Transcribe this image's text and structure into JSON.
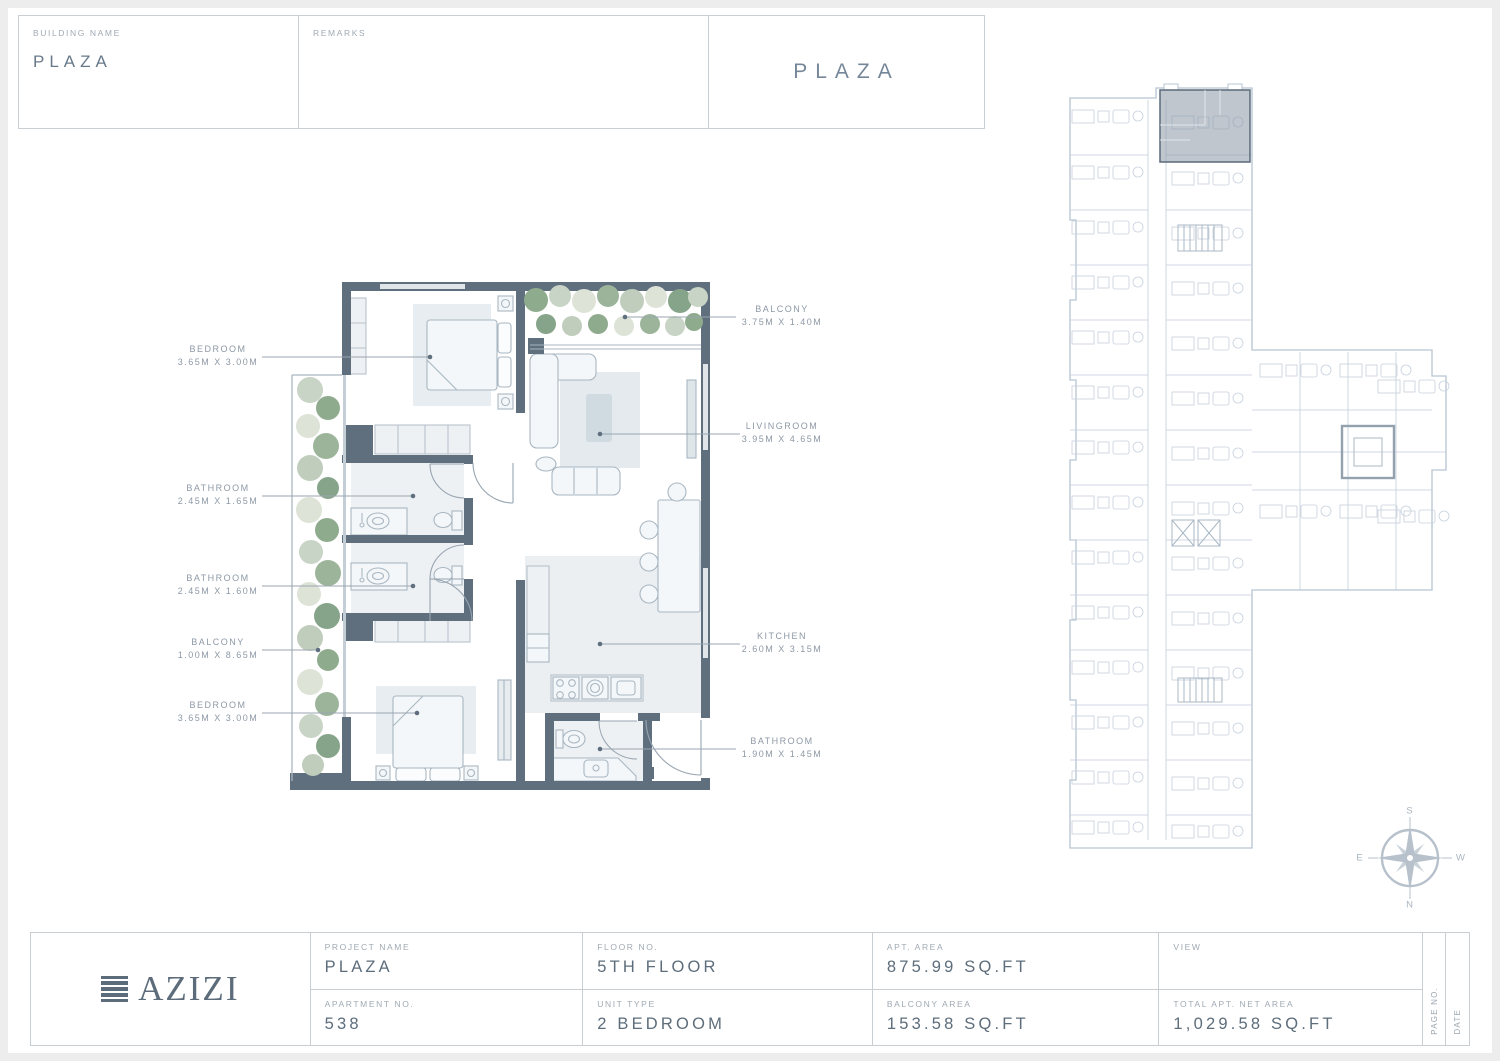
{
  "header": {
    "building_name_label": "BUILDING NAME",
    "building_name_value": "PLAZA",
    "remarks_label": "REMARKS",
    "sheet_title": "PLAZA"
  },
  "floor_plan": {
    "rooms": [
      {
        "name": "BEDROOM",
        "dims": "3.65M X 3.00M"
      },
      {
        "name": "BATHROOM",
        "dims": "2.45M X 1.65M"
      },
      {
        "name": "BATHROOM",
        "dims": "2.45M X 1.60M"
      },
      {
        "name": "BALCONY",
        "dims": "1.00M X 8.65M"
      },
      {
        "name": "BEDROOM",
        "dims": "3.65M X 3.00M"
      },
      {
        "name": "BALCONY",
        "dims": "3.75M X 1.40M"
      },
      {
        "name": "LIVINGROOM",
        "dims": "3.95M X 4.65M"
      },
      {
        "name": "KITCHEN",
        "dims": "2.60M X 3.15M"
      },
      {
        "name": "BATHROOM",
        "dims": "1.90M X 1.45M"
      }
    ]
  },
  "compass": {
    "north": "N",
    "south": "S",
    "east": "E",
    "west": "W"
  },
  "title_block": {
    "logo_text": "AZIZI",
    "project_name_label": "PROJECT NAME",
    "project_name_value": "PLAZA",
    "floor_no_label": "FLOOR NO.",
    "floor_no_value": "5TH FLOOR",
    "apt_area_label": "APT. AREA",
    "apt_area_value": "875.99 SQ.FT",
    "view_label": "VIEW",
    "view_value": "",
    "apartment_no_label": "APARTMENT NO.",
    "apartment_no_value": "538",
    "unit_type_label": "UNIT TYPE",
    "unit_type_value": "2 BEDROOM",
    "balcony_area_label": "BALCONY AREA",
    "balcony_area_value": "153.58 SQ.FT",
    "total_area_label": "TOTAL APT. NET AREA",
    "total_area_value": "1,029.58 SQ.FT",
    "page_no_label": "PAGE NO.",
    "date_label": "DATE"
  },
  "colors": {
    "wall": "#5f6f7e",
    "furniture_line": "#a9b7c2",
    "light_fill": "#eef1f4",
    "tree_green": "#8fab8e",
    "tree_pale": "#dde3d7",
    "overview_line": "#b7c4d2",
    "highlight_unit": "#8a97a5",
    "text_value": "#5d6d7b",
    "text_label": "#9aa5af"
  }
}
